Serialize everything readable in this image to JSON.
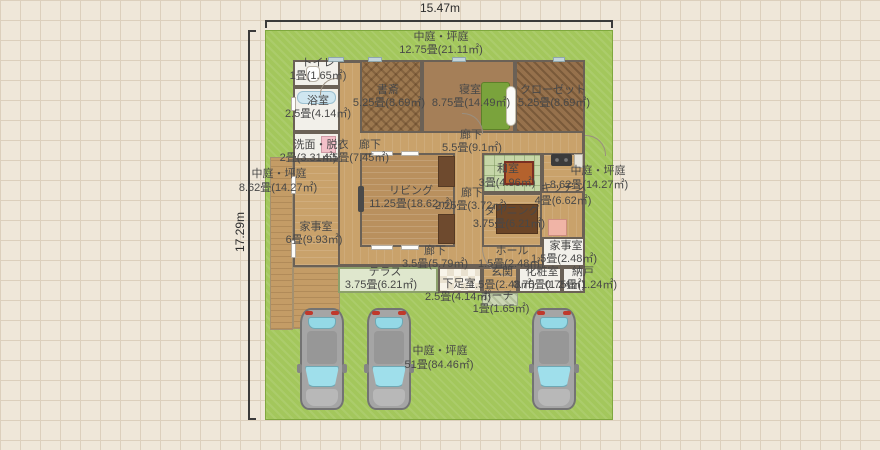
{
  "colors": {
    "paper": "#efe7d9",
    "gridline": "#dccfbc",
    "lot": "#a3c75c",
    "wall": "#6b6156",
    "tan": "#c9a26b",
    "living": "#b9905e",
    "dark": "#9c784f",
    "tatami": "#c6d6a8",
    "terrace": "#dfe7cd",
    "white": "#f2f0ea",
    "carbody": "#a5a5a5",
    "glass": "#9fdfeb",
    "bed": "#7aa33c",
    "table": "#6b4527",
    "text": "#484848"
  },
  "dimensions": {
    "width": "15.47m",
    "height": "17.29m"
  },
  "gardens": {
    "top": {
      "name": "中庭・坪庭",
      "size": "12.75畳(21.11㎡)"
    },
    "left": {
      "name": "中庭・坪庭",
      "size": "8.62畳(14.27㎡)"
    },
    "right": {
      "name": "中庭・坪庭",
      "size": "8.62畳(14.27㎡)"
    },
    "bottom": {
      "name": "中庭・坪庭",
      "size": "51畳(84.46㎡)"
    }
  },
  "rooms": {
    "toilet": {
      "name": "トイレ",
      "size": "1畳(1.65㎡)"
    },
    "bath": {
      "name": "浴室",
      "size": "2.5畳(4.14㎡)"
    },
    "study": {
      "name": "書斎",
      "size": "5.25畳(8.69㎡)"
    },
    "bedroom": {
      "name": "寝室",
      "size": "8.75畳(14.49㎡)"
    },
    "closet": {
      "name": "クローゼット",
      "size": "5.25畳(8.69㎡)"
    },
    "hallway_main": {
      "name": "廊下",
      "size": "5.5畳(9.1㎡)"
    },
    "washroom": {
      "name": "洗面・脱衣",
      "size": "2畳(3.31㎡)"
    },
    "hallway_west": {
      "name": "廊下",
      "size": "4.5畳(7.45㎡)"
    },
    "utility_west": {
      "name": "家事室",
      "size": "6畳(9.93㎡)"
    },
    "living": {
      "name": "リビング",
      "size": "11.25畳(18.62㎡)"
    },
    "hallway_center": {
      "name": "廊下",
      "size": "2.25畳(3.72㎡)"
    },
    "washitsu": {
      "name": "和室",
      "size": "3畳(4.96㎡)"
    },
    "kitchen": {
      "name": "キッチン",
      "size": "4畳(6.62㎡)"
    },
    "dining": {
      "name": "ダイニング",
      "size": "3.75畳(6.21㎡)"
    },
    "hallway_south": {
      "name": "廊下",
      "size": "3.5畳(5.79㎡)"
    },
    "hall": {
      "name": "ホール",
      "size": "1.5畳(2.48㎡)"
    },
    "utility_east": {
      "name": "家事室",
      "size": "1.5畳(2.48㎡)"
    },
    "terrace": {
      "name": "テラス",
      "size": "3.75畳(6.21㎡)"
    },
    "shoe_room": {
      "name": "下足室",
      "size": "2.5畳(4.14㎡)"
    },
    "entrance": {
      "name": "玄関",
      "size": "1.5畳(2.48㎡)"
    },
    "powder_room": {
      "name": "化粧室",
      "size": "0.75畳(1.24㎡)"
    },
    "storage": {
      "name": "納戸",
      "size": "0.75畳(1.24㎡)"
    },
    "porch": {
      "name": "ポーチ",
      "size": "1畳(1.65㎡)"
    }
  }
}
